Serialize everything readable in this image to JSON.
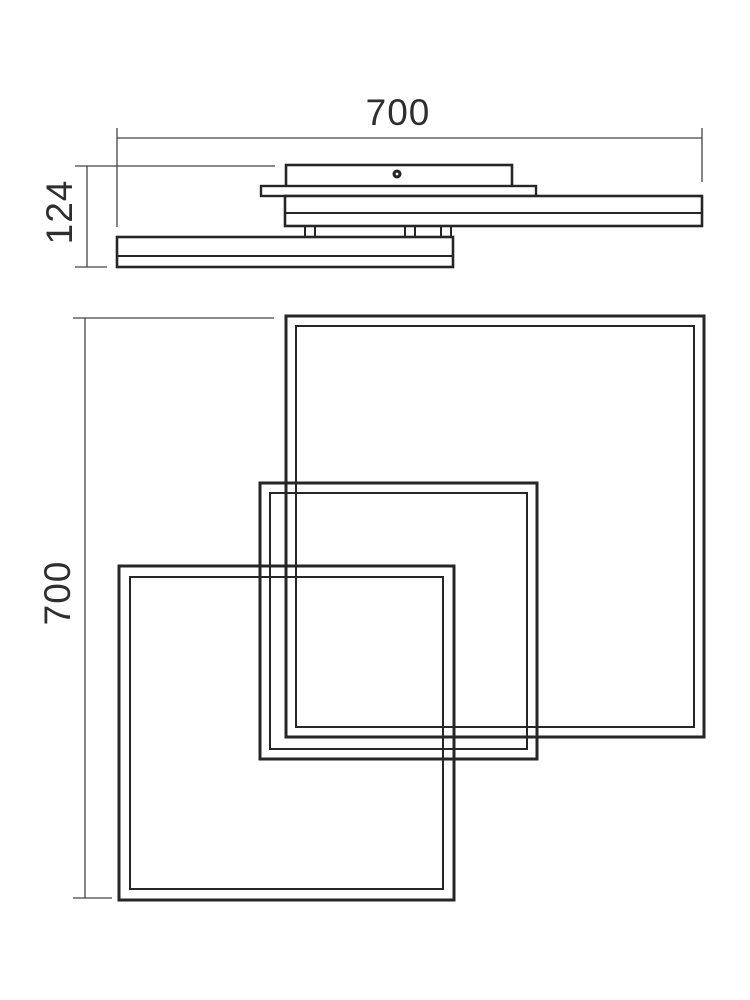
{
  "page": {
    "background": "#ffffff",
    "description": "Technical dimension drawing of a ceiling LED lamp with three overlapping square frames"
  },
  "colors": {
    "outline": "#262626",
    "dimension_line": "#444444",
    "text": "#2e2e2e",
    "fill": "#ffffff"
  },
  "side_view": {
    "width_dimension": {
      "label": "700",
      "label_pos": {
        "x": 398,
        "y": 113,
        "rotate": 0
      },
      "line": {
        "x1": 117,
        "y1": 138,
        "x2": 702,
        "y2": 138
      },
      "extensions": [
        {
          "x1": 117,
          "y1": 128,
          "x2": 117,
          "y2": 227
        },
        {
          "x1": 702,
          "y1": 128,
          "x2": 702,
          "y2": 182
        }
      ]
    },
    "height_dimension": {
      "label": "124",
      "label_pos": {
        "x": 60,
        "y": 212,
        "rotate": -90
      },
      "line": {
        "x1": 87,
        "y1": 166,
        "x2": 87,
        "y2": 267
      },
      "extensions": [
        {
          "x1": 75,
          "y1": 166,
          "x2": 275,
          "y2": 166
        },
        {
          "x1": 75,
          "y1": 267,
          "x2": 107,
          "y2": 267
        }
      ]
    },
    "canopy": {
      "x": 286,
      "y": 165,
      "w": 226,
      "h": 32
    },
    "screw": {
      "cx": 397,
      "cy": 174,
      "r_outer": 4.5,
      "r_inner": 1.4
    },
    "frame_b_profile": {
      "x": 261,
      "y": 186,
      "w": 275,
      "h": 10
    },
    "frame_a_profile": {
      "x": 285,
      "y": 196,
      "w": 417,
      "h": 30,
      "seam_y": 213
    },
    "frame_c_profile": {
      "x": 117,
      "y": 237,
      "w": 336,
      "h": 30,
      "seam_y": 256
    },
    "standoffs": [
      {
        "x": 305,
        "y": 226,
        "w": 10,
        "h": 11
      },
      {
        "x": 405,
        "y": 226,
        "w": 10,
        "h": 11
      },
      {
        "x": 441,
        "y": 226,
        "w": 10,
        "h": 11
      }
    ]
  },
  "plan_view": {
    "height_dimension": {
      "label": "700",
      "label_pos": {
        "x": 58,
        "y": 593,
        "rotate": -90
      },
      "line": {
        "x1": 85,
        "y1": 318,
        "x2": 85,
        "y2": 898
      },
      "extensions": [
        {
          "x1": 73,
          "y1": 318,
          "x2": 274,
          "y2": 318
        },
        {
          "x1": 73,
          "y1": 898,
          "x2": 112,
          "y2": 898
        }
      ]
    },
    "frame_a": {
      "name": "large-square",
      "outer": {
        "x": 286,
        "y": 316,
        "w": 418,
        "h": 421
      },
      "wall": 10
    },
    "frame_b": {
      "name": "medium-square",
      "outer": {
        "x": 260,
        "y": 483,
        "w": 277,
        "h": 276
      },
      "wall": 10
    },
    "frame_c": {
      "name": "small-square",
      "outer": {
        "x": 119,
        "y": 566,
        "w": 335,
        "h": 334
      },
      "wall": 11
    }
  }
}
